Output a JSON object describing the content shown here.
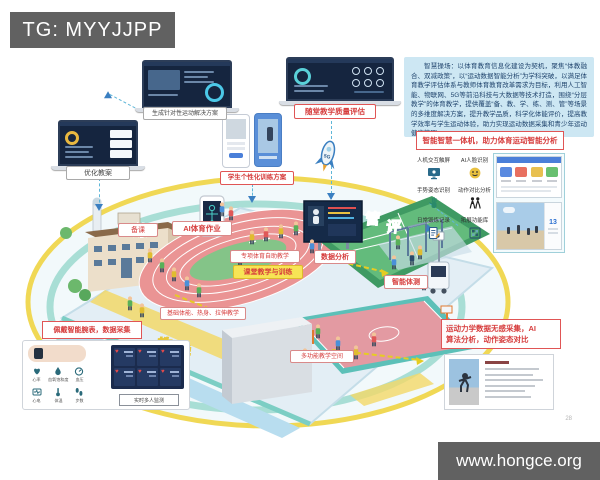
{
  "watermark_top": "TG: MYYJJPP",
  "watermark_bottom": "www.hongce.org",
  "page_number": "28",
  "flow": {
    "laptop_left_label": "优化教案",
    "laptop_center_label": "生成针对性运动解决方案",
    "laptop_right_label": "随堂教学质量评估",
    "phones_label": "学生个性化训练方案",
    "rocket_text": "5G"
  },
  "intro": {
    "text": "智慧操场：以体育教育信息化建设为契机，聚焦“体教融合、双减政策”，以“运动数据智能分析”为学科突破，以满足体育教学评估体系与教师体育教育改革需求为目标，利用人工智能、物联网、5G等前沿科技与大数据等技术打造，围绕“分层教学”的体育教学，提供覆盖“备、教、学、练、测、管”等场景的多维度解决方案，提升教学品质，科学化体能评价，提高教学效率与学生运动体验，助力实现运动数据采集和青少年运动健康管理。"
  },
  "machine": {
    "title": "智能智慧一体机，助力体育运动智能分析",
    "features": [
      {
        "label": "人机交互触屏"
      },
      {
        "label": "AI人脸识别"
      },
      {
        "label": "手势姿态识别"
      },
      {
        "label": "动作对比分析"
      },
      {
        "label": "日常锻炼记录"
      },
      {
        "label": "拓展功能库"
      }
    ],
    "stat": "13"
  },
  "scene": {
    "prep": "备课",
    "ai_homework": "AI体育作业",
    "self_teach": "专项体育自助教学",
    "class_train": "课堂教学与训练",
    "data_analysis": "数据分析",
    "smart_test": "智能体测",
    "basic_teach": "基础体能、热身、拉伸教学",
    "multi_space": "多功能教学空间",
    "outline": {
      "w1": "练",
      "w2": "管",
      "w3": "评",
      "w4": "教",
      "w5": "学"
    }
  },
  "wristband": {
    "title": "佩戴智能腕表，数据采集",
    "metrics": [
      {
        "label": "心率"
      },
      {
        "label": "血氧饱和度"
      },
      {
        "label": "血压"
      },
      {
        "label": "心电"
      },
      {
        "label": "体温"
      },
      {
        "label": "步数"
      }
    ],
    "monitor": "实时多人监测"
  },
  "motion": {
    "title_line1": "运动力学数据无感采集，AI",
    "title_line2": "算法分析，动作姿态对比"
  }
}
